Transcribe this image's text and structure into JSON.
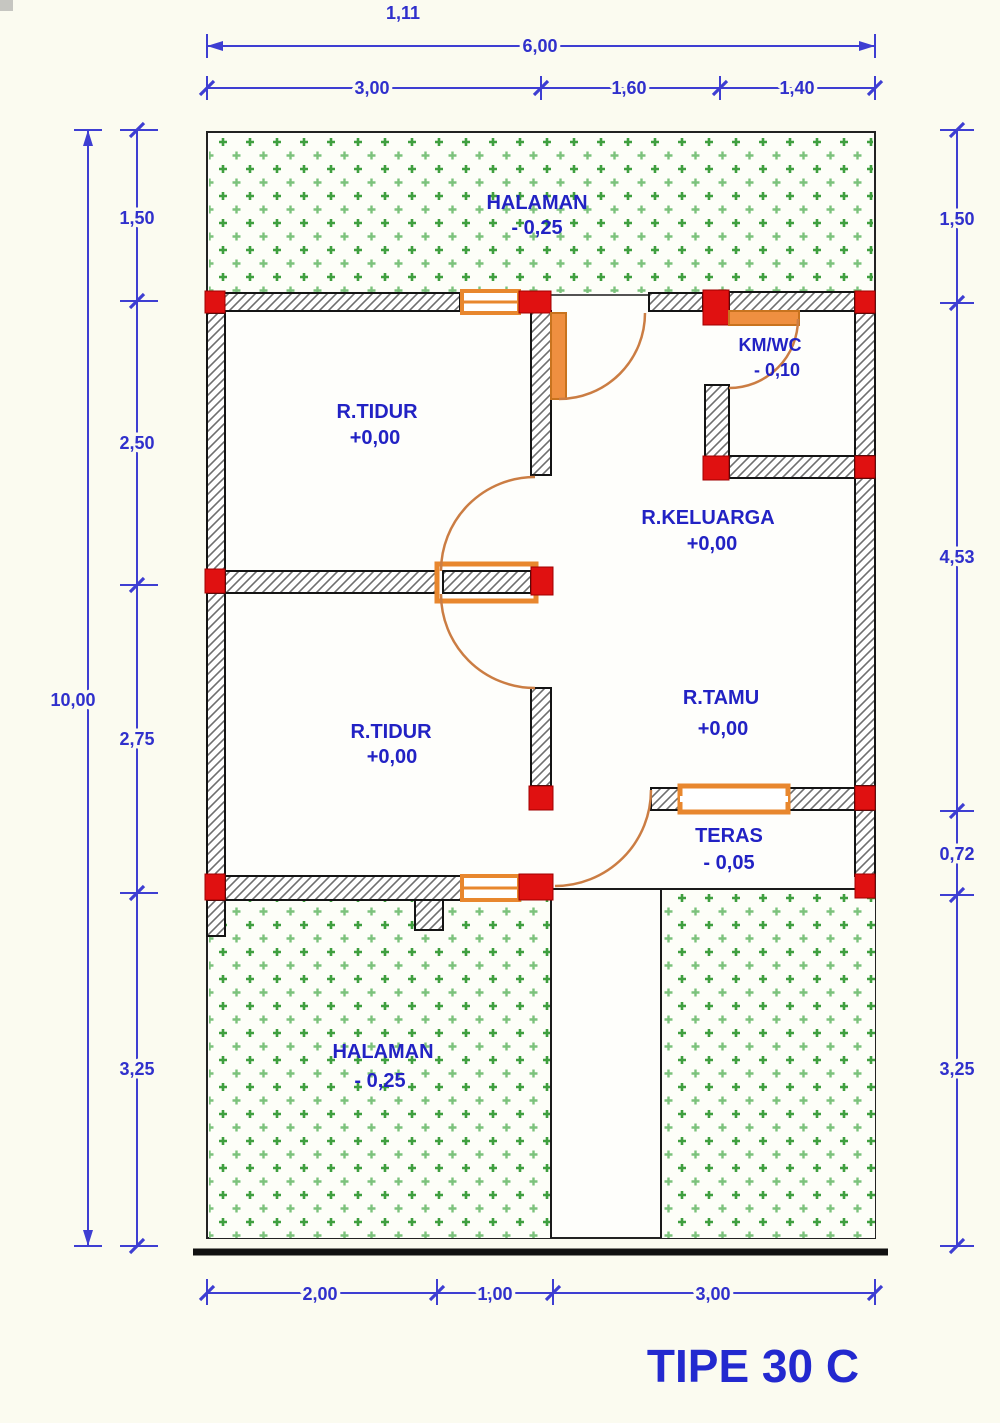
{
  "title": "TIPE 30 C",
  "dimensions": {
    "top": {
      "offset_label": "1,11",
      "total": "6,00",
      "segments": [
        "3,00",
        "1,60",
        "1,40"
      ]
    },
    "left": {
      "total": "10,00",
      "segments": [
        "1,50",
        "2,50",
        "2,75",
        "3,25"
      ]
    },
    "right": {
      "segments": [
        "1,50",
        "4,53",
        "0,72",
        "3,25"
      ]
    },
    "bottom": {
      "segments": [
        "2,00",
        "1,00",
        "3,00"
      ]
    }
  },
  "rooms": [
    {
      "name": "HALAMAN",
      "level": "- 0,25"
    },
    {
      "name": "R.TIDUR",
      "level": "+0,00"
    },
    {
      "name": "KM/WC",
      "level": "- 0,10"
    },
    {
      "name": "R.KELUARGA",
      "level": "+0,00"
    },
    {
      "name": "R.TAMU",
      "level": "+0,00"
    },
    {
      "name": "R.TIDUR",
      "level": "+0,00"
    },
    {
      "name": "TERAS",
      "level": "- 0,05"
    },
    {
      "name": "HALAMAN",
      "level": "- 0,25"
    }
  ],
  "colors": {
    "dimension_blue": "#3e3ed2",
    "label_blue": "#2222c4",
    "column_red": "#e01111",
    "door_orange": "#e8872e",
    "yard_green": "#3f9f3f",
    "wall_hatch_gray": "#6f6f6f"
  }
}
